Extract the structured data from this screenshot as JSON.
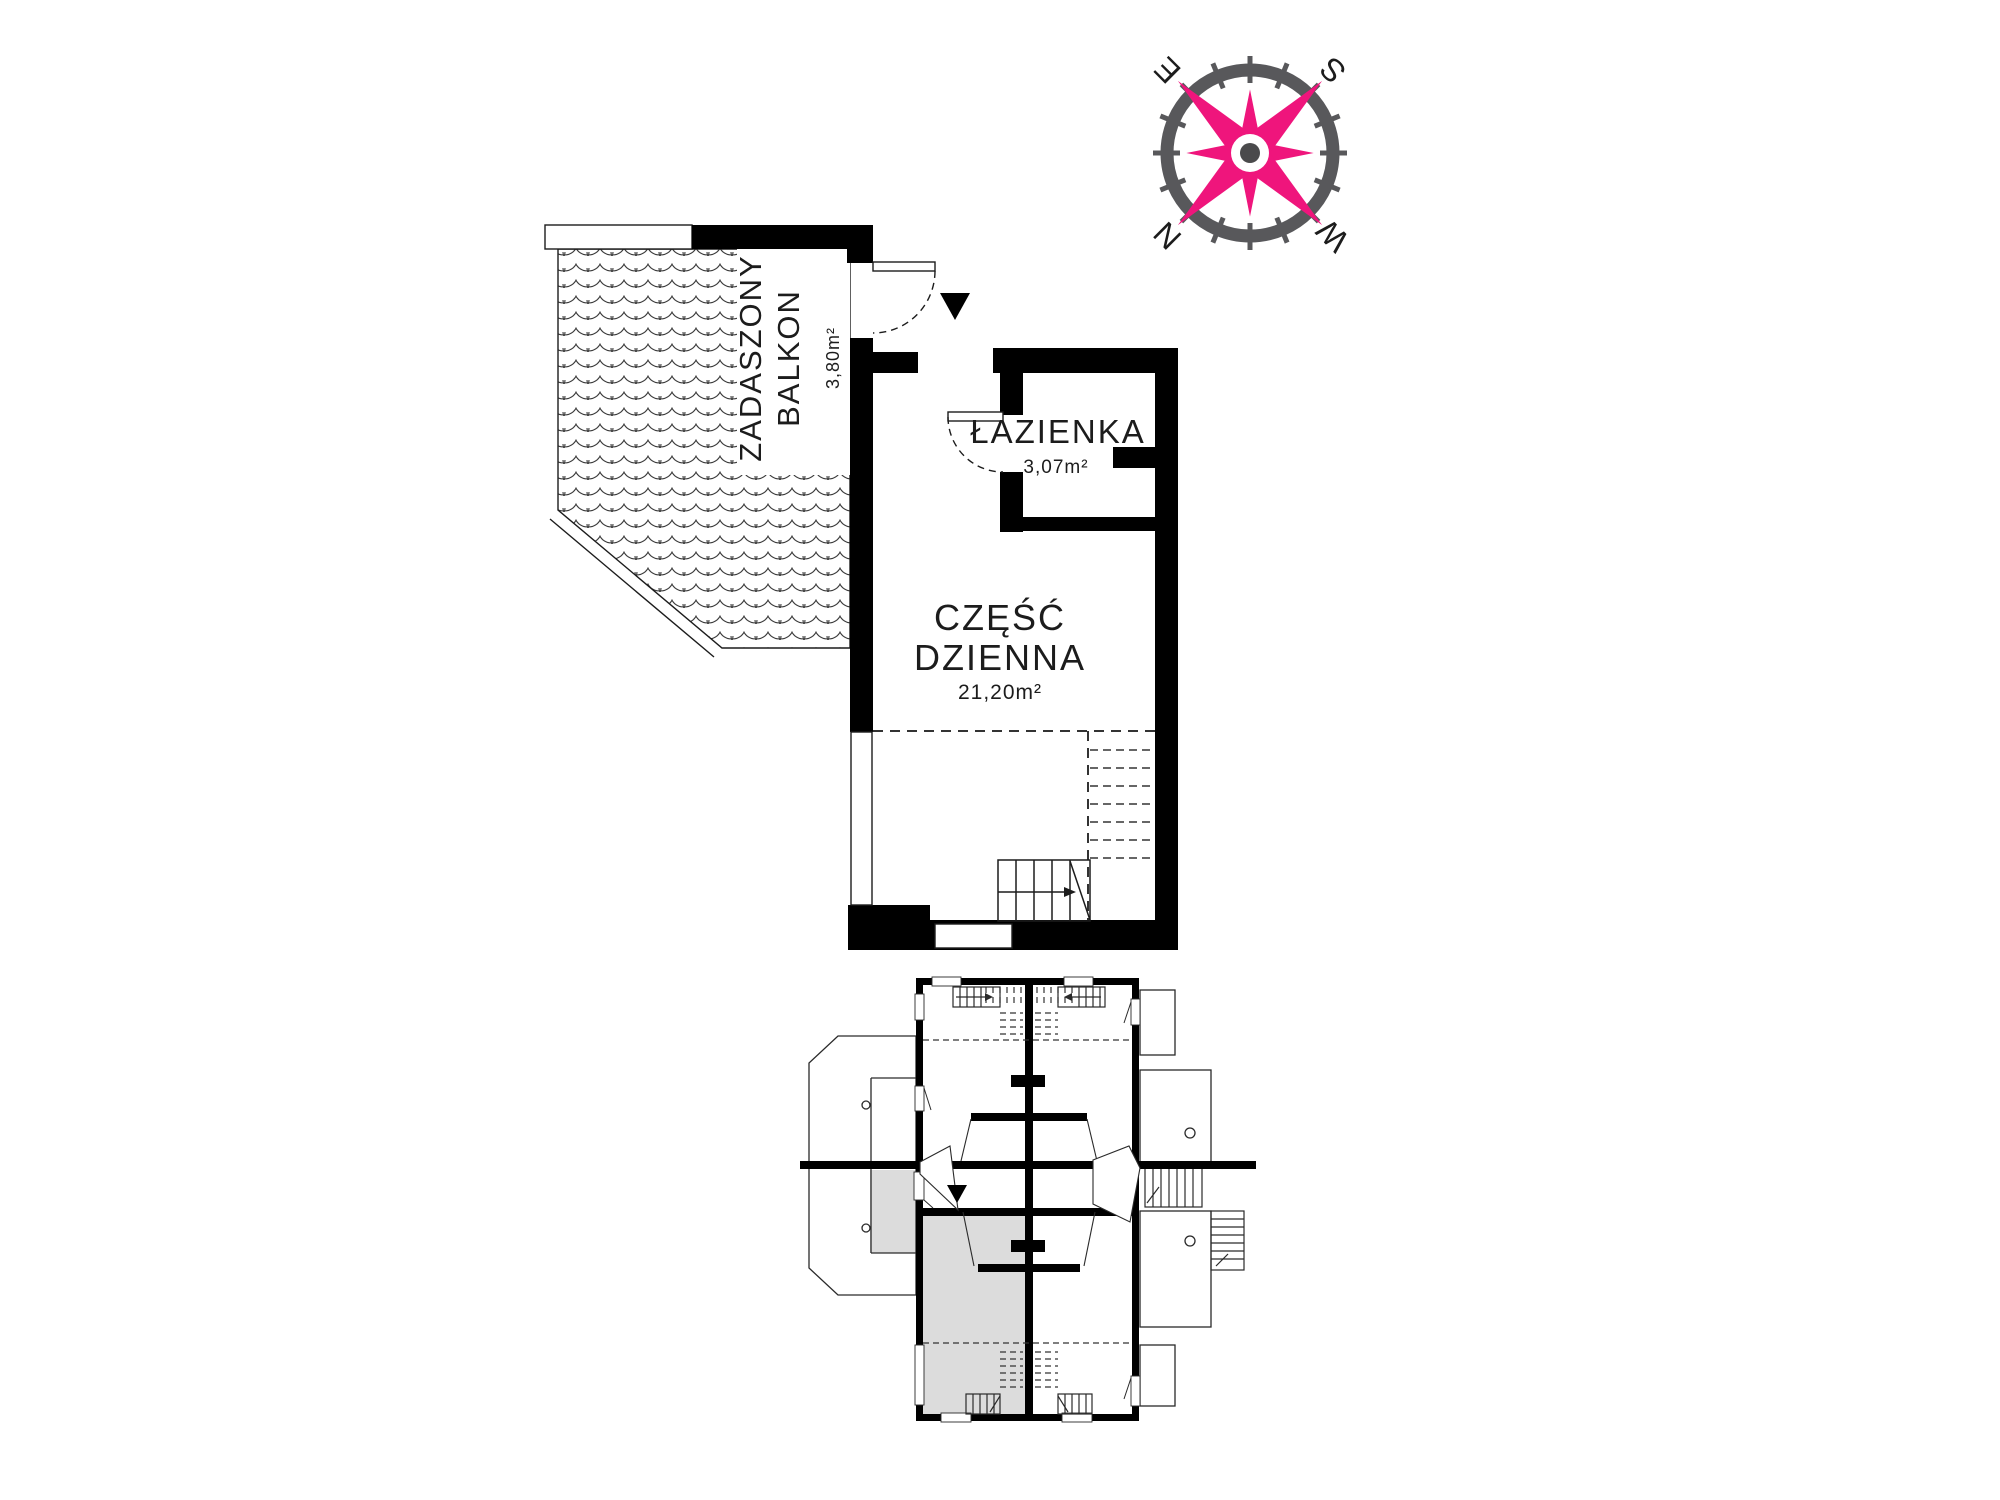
{
  "title": "Apartment floor plan",
  "colors": {
    "wall": "#000000",
    "thin_line": "#1c1c1c",
    "highlight_gray": "#dcdcdc",
    "compass_pink": "#ef157c",
    "compass_gray": "#58585b"
  },
  "compass": {
    "n": "N",
    "e": "E",
    "s": "S",
    "w": "W"
  },
  "rooms": {
    "balcony": {
      "line1": "ZADASZONY",
      "line2": "BALKON",
      "area": "3,80m²"
    },
    "bathroom": {
      "name": "ŁAZIENKA",
      "area": "3,07m²"
    },
    "living": {
      "line1": "CZĘŚĆ",
      "line2": "DZIENNA",
      "area": "21,20m²"
    }
  }
}
